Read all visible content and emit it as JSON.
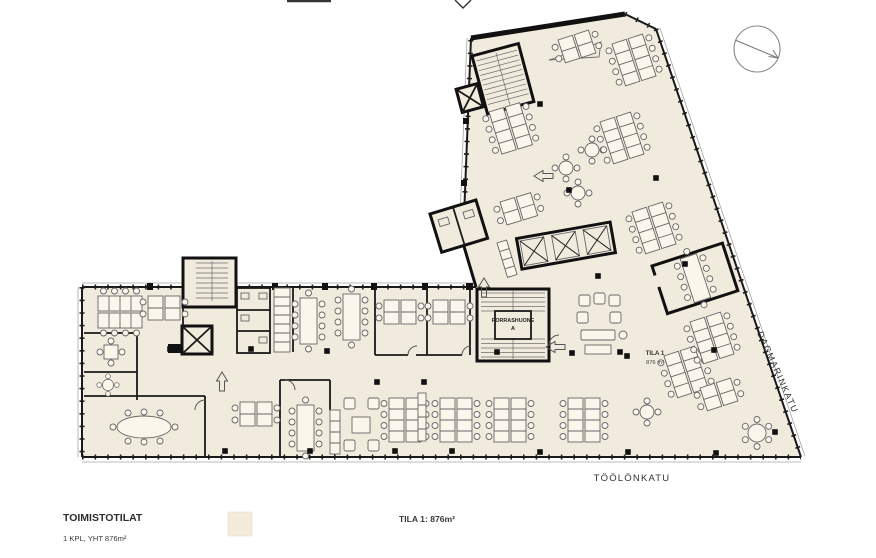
{
  "plan": {
    "stair_label_line1": "PORRASHUONE",
    "stair_label_line2": "A",
    "area_label_line1": "TILA 1",
    "area_label_line2": "876 m²",
    "street_right": "DAGMARINKATU",
    "street_bottom": "TÖÖLÖNKATU"
  },
  "legend": {
    "title": "TOIMISTOTILAT",
    "subtitle": "1 KPL, YHT 876m²",
    "area_total": "TILA 1: 876m²",
    "swatch_color": "#f3ecdd"
  },
  "colors": {
    "floor": "#f1ebde",
    "wall": "#1a1a1a",
    "furniture": "#666666"
  },
  "icons": {
    "north_arrow": "compass-north-arrow"
  }
}
